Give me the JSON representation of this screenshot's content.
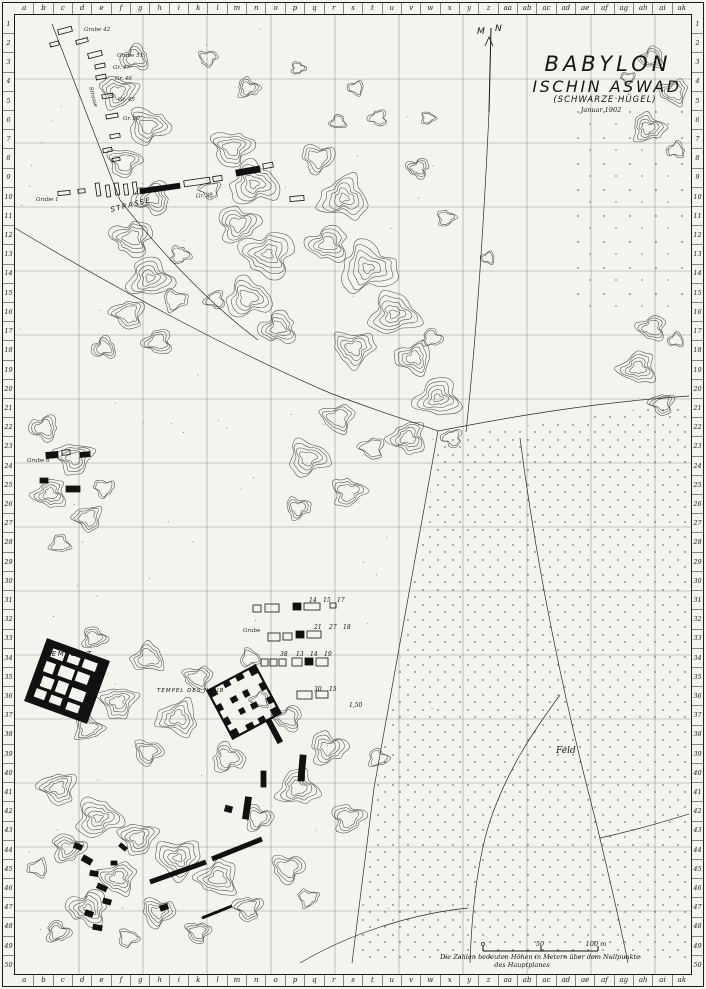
{
  "paper_color": "#f4f3ee",
  "ink_color": "#1c1c1c",
  "title": {
    "line1": "BABYLON",
    "line2": "ISCHIN ASWAD",
    "line3": "(SCHWARZE HÜGEL)",
    "line4": "Januar 1902"
  },
  "compass": {
    "m": "M",
    "n": "N"
  },
  "grid_index": {
    "columns": [
      "a",
      "b",
      "c",
      "d",
      "e",
      "f",
      "g",
      "h",
      "i",
      "k",
      "l",
      "m",
      "n",
      "o",
      "p",
      "q",
      "r",
      "s",
      "t",
      "u",
      "v",
      "w",
      "x",
      "y",
      "z",
      "aa",
      "ab",
      "ac",
      "ad",
      "ae",
      "af",
      "ag",
      "ah",
      "ai",
      "ak"
    ],
    "rows": [
      "1",
      "2",
      "3",
      "4",
      "5",
      "6",
      "7",
      "8",
      "9",
      "10",
      "11",
      "12",
      "13",
      "14",
      "15",
      "16",
      "17",
      "18",
      "19",
      "20",
      "21",
      "22",
      "23",
      "24",
      "25",
      "26",
      "27",
      "28",
      "29",
      "30",
      "31",
      "32",
      "33",
      "34",
      "35",
      "36",
      "37",
      "38",
      "39",
      "40",
      "41",
      "42",
      "43",
      "44",
      "45",
      "46",
      "47",
      "48",
      "49",
      "50"
    ]
  },
  "labels": {
    "strasse": "STRASSE",
    "tempel_z": "TEMPEL Z",
    "tempel_des_ninib": "TEMPEL DES NINIB",
    "feld": "Feld"
  },
  "pit_labels": [
    {
      "text": "Grube 42",
      "x": 84,
      "y": 27,
      "rot": 0
    },
    {
      "text": "Grube 51",
      "x": 117,
      "y": 53,
      "rot": 0
    },
    {
      "text": "Gr. 47",
      "x": 113,
      "y": 65,
      "rot": 0
    },
    {
      "text": "Gr. 46",
      "x": 115,
      "y": 76,
      "rot": 0
    },
    {
      "text": "Gr. 45",
      "x": 118,
      "y": 97,
      "rot": 0
    },
    {
      "text": "Gr. 50",
      "x": 123,
      "y": 116,
      "rot": 0
    },
    {
      "text": "Strasse",
      "x": 90,
      "y": 84,
      "rot": 75
    },
    {
      "text": "Grube 1",
      "x": 36,
      "y": 197,
      "rot": 0
    },
    {
      "text": "Gr. 38",
      "x": 196,
      "y": 194,
      "rot": -6
    },
    {
      "text": "Grube 6",
      "x": 27,
      "y": 458,
      "rot": 0
    },
    {
      "text": "Grube",
      "x": 243,
      "y": 628,
      "rot": 0
    }
  ],
  "trench_numbers": [
    {
      "text": "14",
      "x": 309,
      "y": 597
    },
    {
      "text": "15",
      "x": 323,
      "y": 597
    },
    {
      "text": "17",
      "x": 337,
      "y": 597
    },
    {
      "text": "21",
      "x": 314,
      "y": 624
    },
    {
      "text": "27",
      "x": 329,
      "y": 624
    },
    {
      "text": "18",
      "x": 343,
      "y": 624
    },
    {
      "text": "38",
      "x": 280,
      "y": 651
    },
    {
      "text": "13",
      "x": 296,
      "y": 651
    },
    {
      "text": "14",
      "x": 310,
      "y": 651
    },
    {
      "text": "19",
      "x": 324,
      "y": 651
    },
    {
      "text": "30",
      "x": 314,
      "y": 686
    },
    {
      "text": "15",
      "x": 329,
      "y": 686
    },
    {
      "text": "1,50",
      "x": 349,
      "y": 702
    }
  ],
  "scale_bar": {
    "mid_label": "50",
    "end_label": "100 m"
  },
  "note": {
    "line1": "Die Zahlen bedeuten Höhen in Metern über dem Nullpunkte",
    "line2": "des Hauptplanes"
  }
}
